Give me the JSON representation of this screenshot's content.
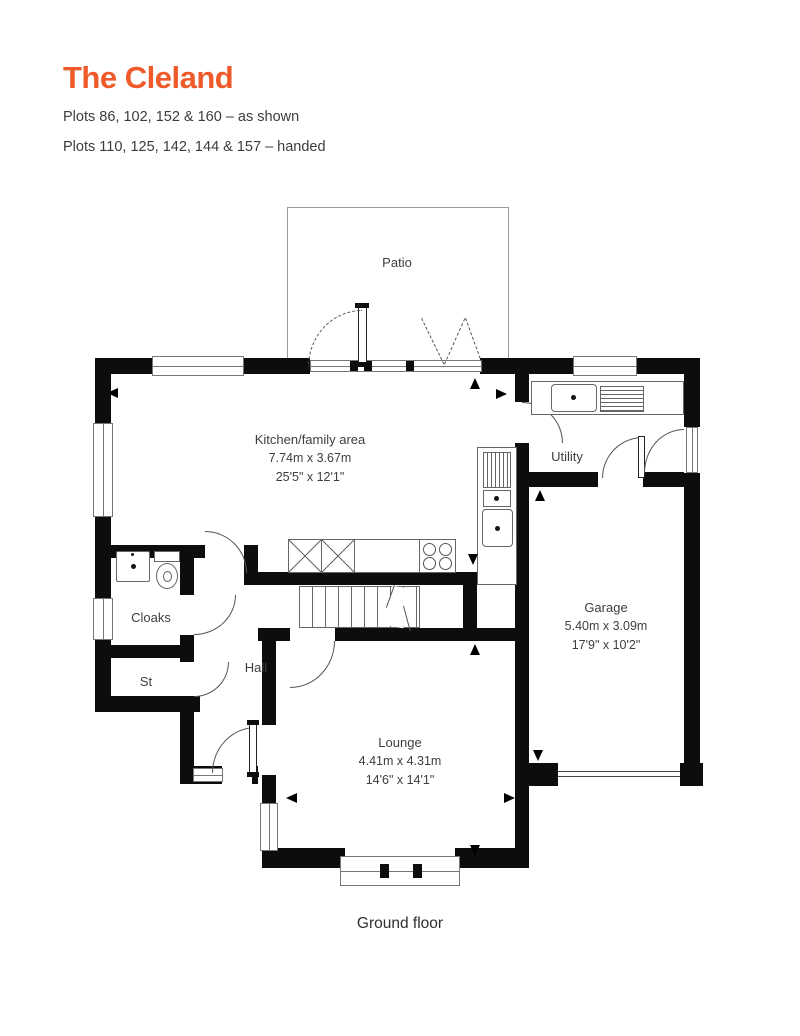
{
  "header": {
    "title": "The Cleland",
    "title_color": "#ee5a29",
    "plots_as_shown": "Plots 86, 102, 152 & 160 – as shown",
    "plots_handed": "Plots 110, 125, 142, 144 & 157 – handed"
  },
  "floor_plan": {
    "patio_label": "Patio",
    "caption": "Ground floor",
    "wall_color": "#0d0d0d",
    "line_color": "#777777",
    "rooms": {
      "kitchen": {
        "name": "Kitchen/family area",
        "metric": "7.74m x 3.67m",
        "imperial": "25'5\" x 12'1\""
      },
      "utility": {
        "name": "Utility"
      },
      "garage": {
        "name": "Garage",
        "metric": "5.40m x 3.09m",
        "imperial": "17'9\" x 10'2\""
      },
      "cloaks": {
        "name": "Cloaks"
      },
      "store": {
        "name": "St"
      },
      "hall": {
        "name": "Hall"
      },
      "lounge": {
        "name": "Lounge",
        "metric": "4.41m x 4.31m",
        "imperial": "14'6\" x 14'1\""
      }
    }
  }
}
